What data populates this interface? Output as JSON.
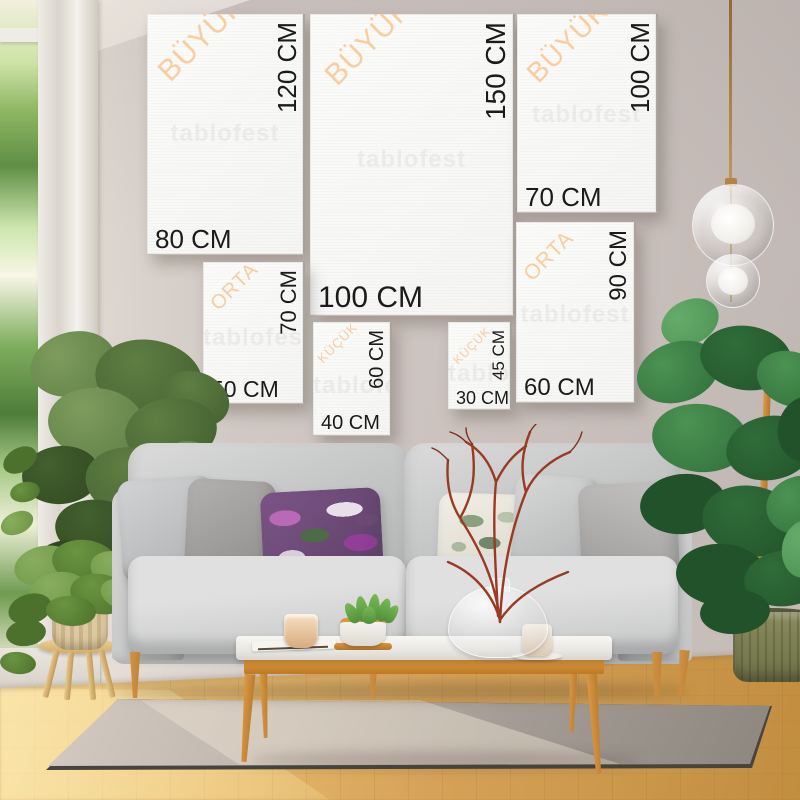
{
  "watermark": "tablofest",
  "size_chart": {
    "unit": "CM",
    "categories": [
      "BÜYÜK",
      "ORTA",
      "KÜÇÜK"
    ],
    "panels": [
      {
        "category": "BÜYÜK",
        "width_label": "80 CM",
        "height_label": "120 CM",
        "x": 147,
        "y": 14,
        "w": 158,
        "h": 241,
        "label_px": 26,
        "vlabel_px": 26,
        "cat_px": 30,
        "cat_x": 6,
        "cat_y": 52
      },
      {
        "category": "BÜYÜK",
        "width_label": "100 CM",
        "height_label": "150 CM",
        "x": 310,
        "y": 14,
        "w": 205,
        "h": 302,
        "label_px": 30,
        "vlabel_px": 28,
        "cat_px": 30,
        "cat_x": 10,
        "cat_y": 56
      },
      {
        "category": "BÜYÜK",
        "width_label": "70 CM",
        "height_label": "100 CM",
        "x": 517,
        "y": 14,
        "w": 141,
        "h": 199,
        "label_px": 26,
        "vlabel_px": 26,
        "cat_px": 28,
        "cat_x": 5,
        "cat_y": 54
      },
      {
        "category": "ORTA",
        "width_label": "50 CM",
        "height_label": "70 CM",
        "x": 203,
        "y": 262,
        "w": 102,
        "h": 142,
        "label_px": 23,
        "vlabel_px": 22,
        "cat_px": 20,
        "cat_x": 4,
        "cat_y": 38
      },
      {
        "category": "KÜÇÜK",
        "width_label": "40 CM",
        "height_label": "60 CM",
        "x": 313,
        "y": 322,
        "w": 79,
        "h": 114,
        "label_px": 20,
        "vlabel_px": 20,
        "cat_px": 13,
        "cat_x": 2,
        "cat_y": 34
      },
      {
        "category": "KÜÇÜK",
        "width_label": "30 CM",
        "height_label": "45 CM",
        "x": 448,
        "y": 322,
        "w": 64,
        "h": 88,
        "label_px": 18,
        "vlabel_px": 17,
        "cat_px": 12,
        "cat_x": 3,
        "cat_y": 36
      },
      {
        "category": "ORTA",
        "width_label": "60 CM",
        "height_label": "90 CM",
        "x": 516,
        "y": 222,
        "w": 120,
        "h": 181,
        "label_px": 24,
        "vlabel_px": 24,
        "cat_px": 21,
        "cat_x": 4,
        "cat_y": 48
      }
    ]
  },
  "colors": {
    "category_label": "#f8cda0",
    "dimension_label": "#1b1b1b",
    "panel_canvas": "#f8f8f6",
    "wood_accent": "#d08a33",
    "wall": "#cbc2bd"
  }
}
